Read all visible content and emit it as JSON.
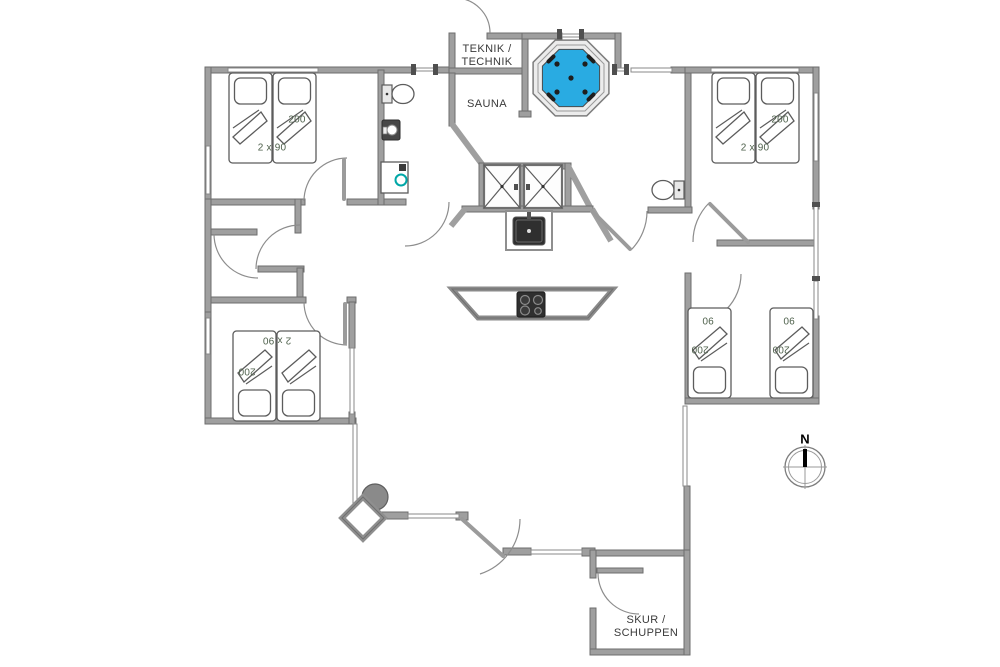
{
  "plan": {
    "rooms": {
      "teknik": {
        "label_line1": "TEKNIK /",
        "label_line2": "TECHNIK"
      },
      "sauna": {
        "label": "SAUNA"
      },
      "shed": {
        "label_line1": "SKUR /",
        "label_line2": "SCHUPPEN"
      }
    },
    "beds": {
      "top_left_pair": {
        "length_label": "200",
        "size_label": "2 x 90"
      },
      "top_right_pair": {
        "length_label": "200",
        "size_label": "2 x 90"
      },
      "bottom_left_pair": {
        "length_label": "200",
        "size_label": "2 x 90"
      },
      "right_room_bed_1": {
        "width_label": "90",
        "length_label": "200"
      },
      "right_room_bed_2": {
        "width_label": "90",
        "length_label": "200"
      }
    },
    "compass": {
      "north_label": "N"
    },
    "colors": {
      "hot_tub_water": "#29ABE2",
      "washer_door_accent": "#00A7A7",
      "wall_fill": "#9F9F9F",
      "bed_label_text": "#4F614C"
    }
  }
}
